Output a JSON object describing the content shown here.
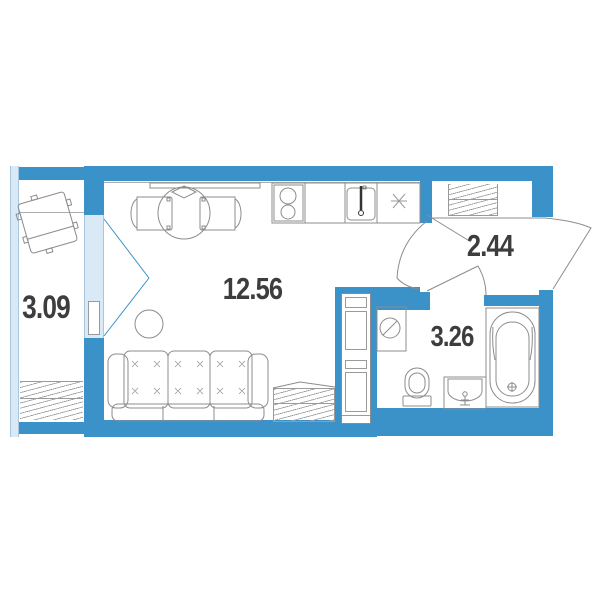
{
  "plan": {
    "type": "studio-apartment-floor-plan",
    "rooms": [
      {
        "id": "balcony",
        "area": "3.09"
      },
      {
        "id": "living-room",
        "area": "12.56"
      },
      {
        "id": "hallway",
        "area": "2.44"
      },
      {
        "id": "bathroom",
        "area": "3.26"
      }
    ],
    "colors": {
      "wall": "#3B92C8",
      "glazing": "#D9E9F6",
      "furniture_line": "#8C8C8C",
      "label_text": "#3D3D3D"
    }
  }
}
